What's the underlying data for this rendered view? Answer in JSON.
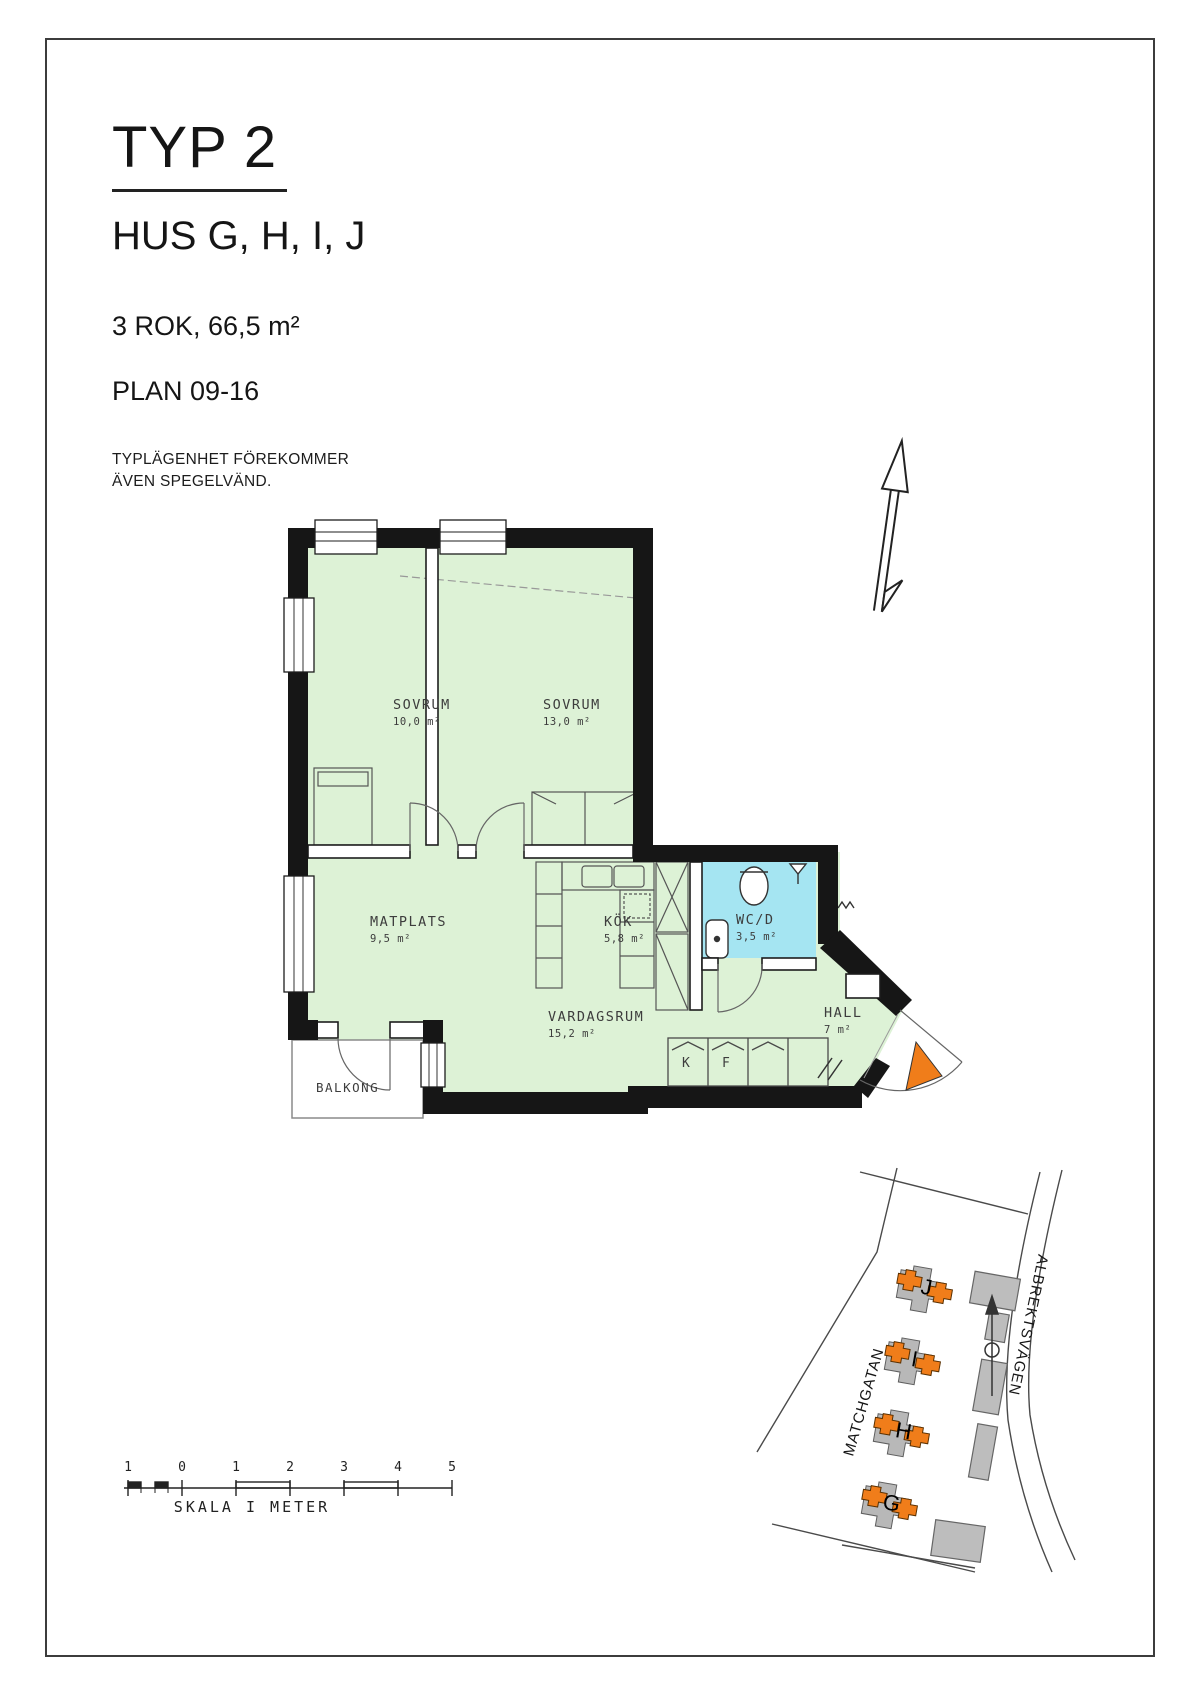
{
  "header": {
    "title": "TYP 2",
    "subtitle": "HUS G, H, I, J",
    "size_line": "3 ROK, 66,5 m²",
    "plan_line": "PLAN 09-16",
    "note_line1": "TYPLÄGENHET FÖREKOMMER",
    "note_line2": "ÄVEN SPEGELVÄND."
  },
  "rooms": {
    "sovrum1": {
      "name": "SOVRUM",
      "area": "10,0 m²"
    },
    "sovrum2": {
      "name": "SOVRUM",
      "area": "13,0 m²"
    },
    "matplats": {
      "name": "MATPLATS",
      "area": "9,5 m²"
    },
    "kok": {
      "name": "KÖK",
      "area": "5,8 m²"
    },
    "vardagsrum": {
      "name": "VARDAGSRUM",
      "area": "15,2 m²"
    },
    "wcd": {
      "name": "WC/D",
      "area": "3,5 m²"
    },
    "hall": {
      "name": "HALL",
      "area": "7 m²"
    },
    "balkong": {
      "name": "BALKONG"
    }
  },
  "closets": {
    "k": "K",
    "f": "F"
  },
  "scale_bar": {
    "numbers": [
      "1",
      "0",
      "1",
      "2",
      "3",
      "4",
      "5"
    ],
    "caption": "SKALA I METER"
  },
  "site_plan": {
    "streets": {
      "left": "MATCHGATAN",
      "right": "ALBREKTSVÄGEN"
    },
    "buildings": [
      "J",
      "I",
      "H",
      "G"
    ]
  },
  "colors": {
    "room_green": "#ddf2d6",
    "wet_room_blue": "#a5e5f2",
    "highlight_orange": "#f07d1a",
    "building_gray": "#b8b8b8",
    "wall_black": "#161616"
  }
}
